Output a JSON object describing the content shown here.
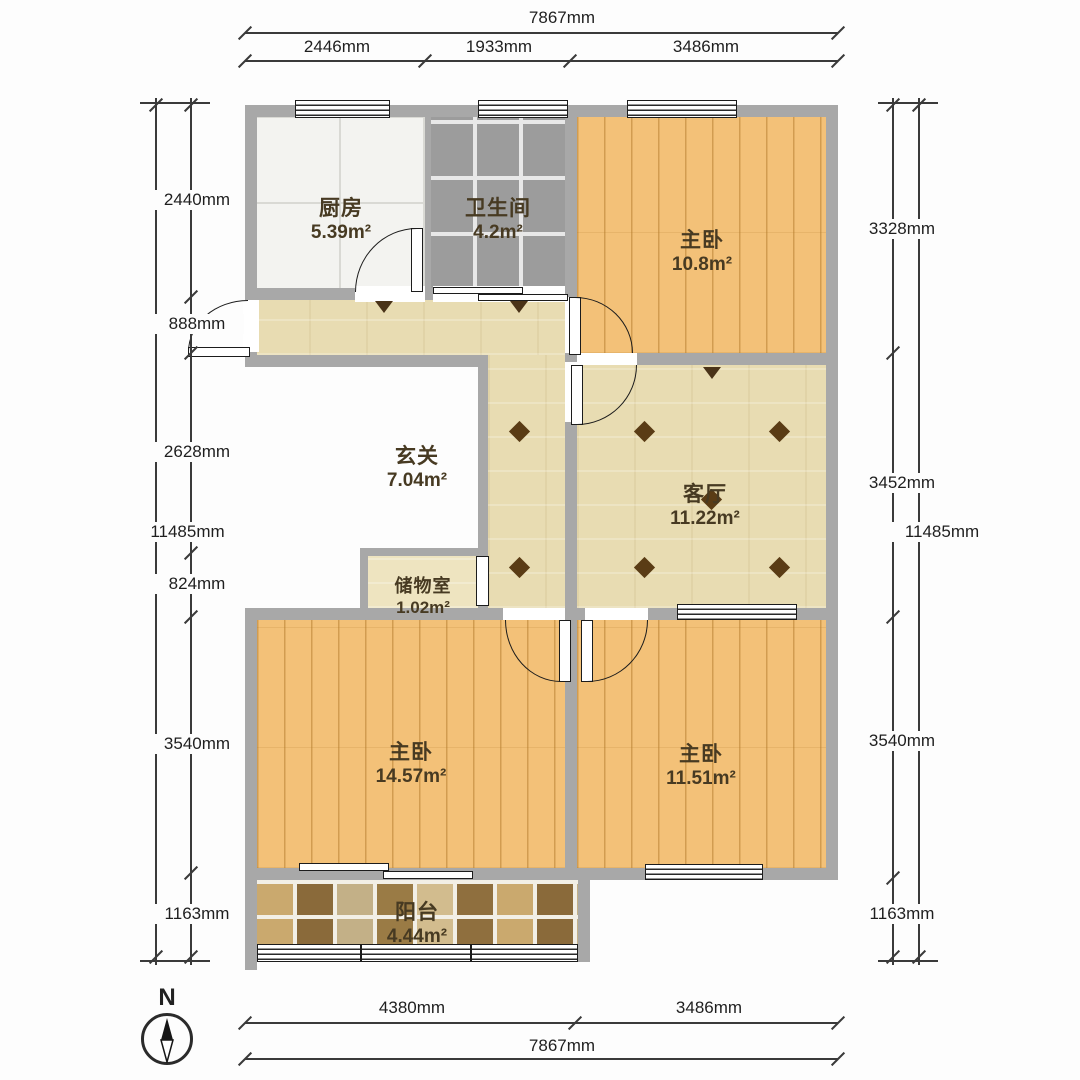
{
  "compass": {
    "north_label": "N"
  },
  "rooms": {
    "kitchen": {
      "name": "厨房",
      "area": "5.39m²"
    },
    "bathroom": {
      "name": "卫生间",
      "area": "4.2m²"
    },
    "bedroom_ne": {
      "name": "主卧",
      "area": "10.8m²"
    },
    "hallway": {
      "name": "玄关",
      "area": "7.04m²"
    },
    "living_room": {
      "name": "客厅",
      "area": "11.22m²"
    },
    "storage": {
      "name": "储物室",
      "area": "1.02m²"
    },
    "bedroom_sw": {
      "name": "主卧",
      "area": "14.57m²"
    },
    "bedroom_se": {
      "name": "主卧",
      "area": "11.51m²"
    },
    "balcony": {
      "name": "阳台",
      "area": "4.44m²"
    }
  },
  "dimensions": {
    "top": {
      "overall": "7867mm",
      "segments": [
        "2446mm",
        "1933mm",
        "3486mm"
      ]
    },
    "bottom": {
      "overall": "7867mm",
      "segments": [
        "4380mm",
        "3486mm"
      ]
    },
    "left": {
      "overall": "11485mm",
      "segments": [
        "2440mm",
        "888mm",
        "2628mm",
        "824mm",
        "3540mm",
        "1163mm"
      ]
    },
    "right": {
      "overall": "11485mm",
      "segments": [
        "3328mm",
        "3452mm",
        "3540mm",
        "1163mm"
      ]
    }
  },
  "colors": {
    "wall": "#a8a8a8",
    "wood_floor": "#f3c178",
    "beige_tile": "#e8dcb2",
    "bathroom_tile": "#9c9c9c",
    "kitchen_tile": "#f3f3f0",
    "balcony_mosaic": "#9a7b45",
    "diamond_accent": "#5a3c15"
  }
}
